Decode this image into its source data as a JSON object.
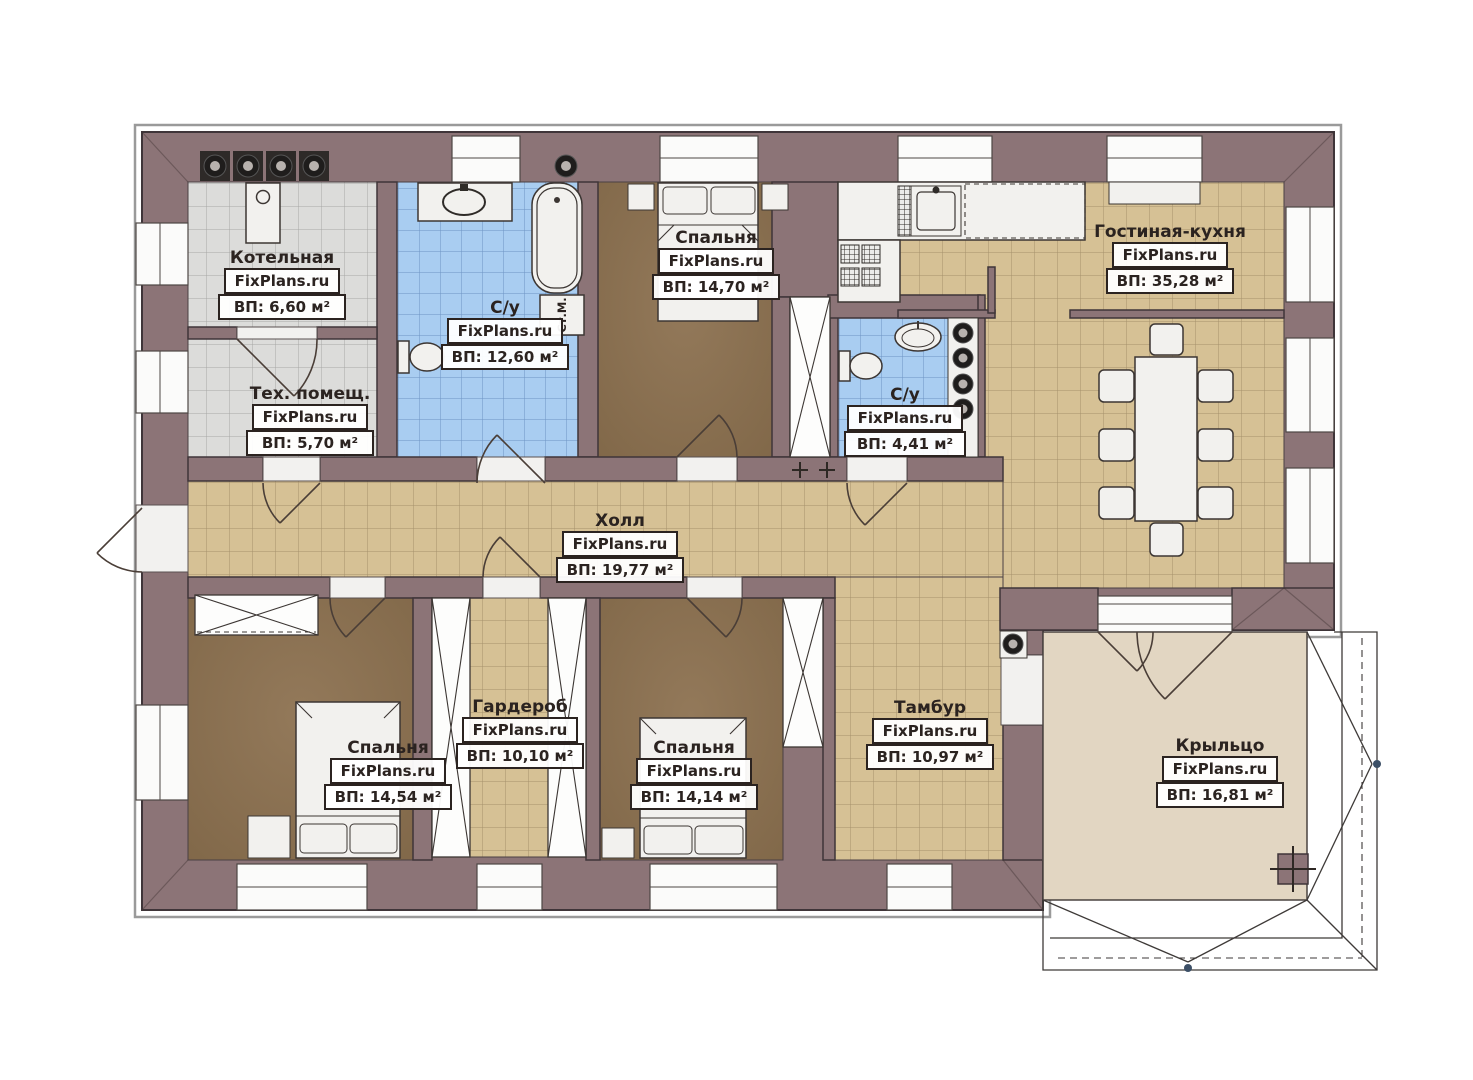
{
  "brand": "FixPlans.ru",
  "rooms": {
    "boiler": {
      "name": "Котельная",
      "area": "ВП: 6,60 м²"
    },
    "tech": {
      "name": "Тех. помещ.",
      "area": "ВП: 5,70 м²"
    },
    "bathroom_main": {
      "name": "С/у",
      "area": "ВП: 12,60 м²"
    },
    "bedroom_top": {
      "name": "Спальня",
      "area": "ВП: 14,70 м²"
    },
    "bathroom_small": {
      "name": "С/у",
      "area": "ВП: 4,41 м²"
    },
    "living_kitchen": {
      "name": "Гостиная-кухня",
      "area": "ВП: 35,28 м²"
    },
    "hall": {
      "name": "Холл",
      "area": "ВП: 19,77 м²"
    },
    "bedroom_left": {
      "name": "Спальня",
      "area": "ВП: 14,54 м²"
    },
    "wardrobe": {
      "name": "Гардероб",
      "area": "ВП: 10,10 м²"
    },
    "bedroom_mid": {
      "name": "Спальня",
      "area": "ВП: 14,14 м²"
    },
    "tambour": {
      "name": "Тамбур",
      "area": "ВП: 10,97 м²"
    },
    "porch": {
      "name": "Крыльцо",
      "area": "ВП: 16,81 м²"
    }
  },
  "labels": {
    "washing_machine": "Ст.М."
  },
  "colors": {
    "wall": "#8c7477",
    "tile_grey": "#dcdcda",
    "tile_blue": "#a9cdf1",
    "tile_beige": "#d6c195",
    "floor_brown": "#8a7153",
    "floor_porch": "#e2d6c2",
    "fixture_white": "#f2f1ee",
    "outline": "#3f3539"
  }
}
